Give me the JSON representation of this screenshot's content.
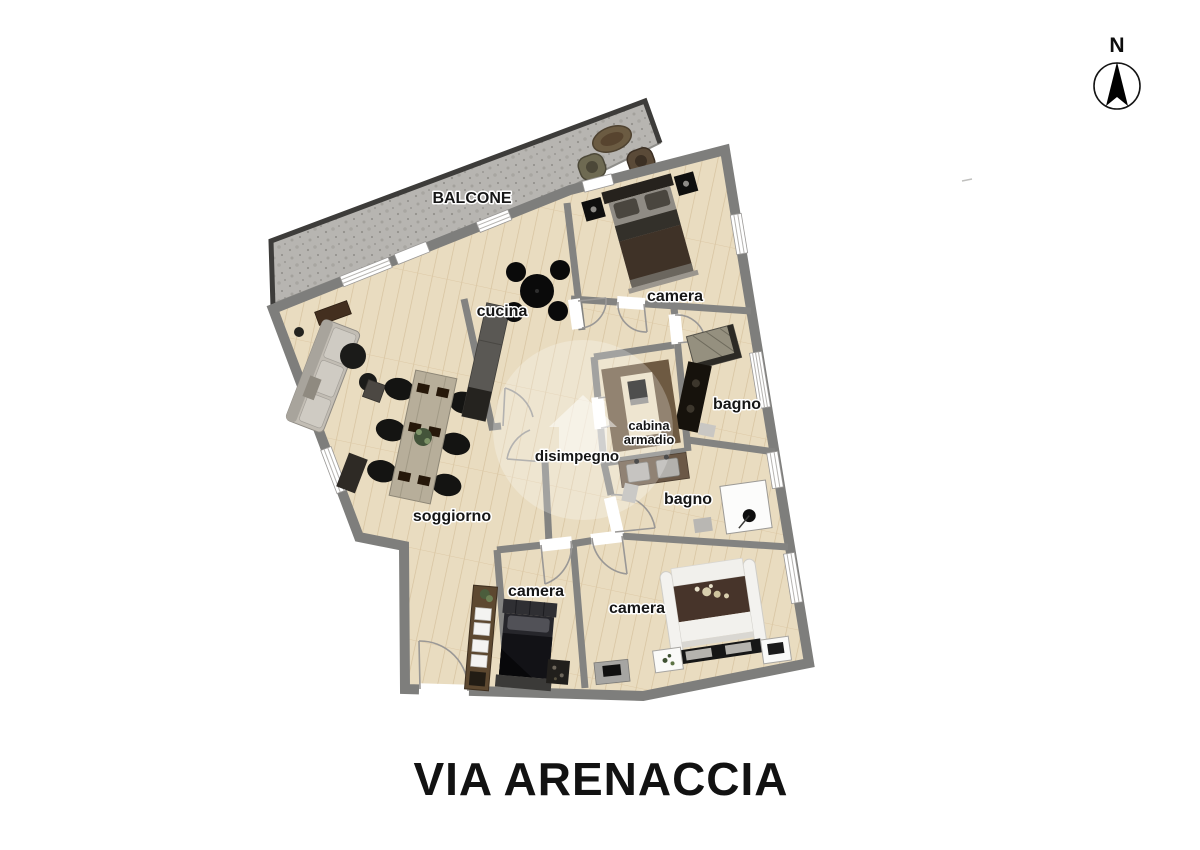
{
  "floorplan": {
    "rooms": [
      {
        "id": "balcone",
        "label": "BALCONE"
      },
      {
        "id": "cucina",
        "label": "cucina"
      },
      {
        "id": "camera-nord",
        "label": "camera"
      },
      {
        "id": "bagno-nord",
        "label": "bagno"
      },
      {
        "id": "cabina-armadio",
        "label_line1": "cabina",
        "label_line2": "armadio"
      },
      {
        "id": "disimpegno",
        "label": "disimpegno"
      },
      {
        "id": "bagno-sud",
        "label": "bagno"
      },
      {
        "id": "soggiorno",
        "label": "soggiorno"
      },
      {
        "id": "camera-piccola",
        "label": "camera"
      },
      {
        "id": "camera-grande",
        "label": "camera"
      }
    ],
    "palette": {
      "floor_wood": "#e9dcc0",
      "floor_line": "#d6c29e",
      "wall_gray": "#858583",
      "wall_dark": "#6d6d6b",
      "balcony_gray": "#b7b5b1",
      "balcony_edge": "#3d3c3a",
      "furniture_dark": "#1c1c1a",
      "wood_dark": "#5d4830",
      "bed_brown": "#47342a",
      "text": "#161616"
    }
  },
  "compass": {
    "label": "N"
  },
  "footer": {
    "title": "VIA ARENACCIA"
  }
}
